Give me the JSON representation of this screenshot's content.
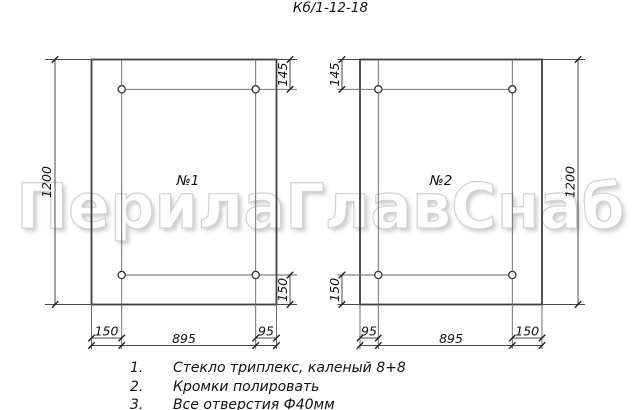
{
  "title": "Кб/1-12-18",
  "watermark": "ПерилаГлавСнаб",
  "colors": {
    "line": "#3f3f3f",
    "watermark": "#e8e8e8"
  },
  "panels": [
    {
      "label": "№1",
      "height_dim": "1200",
      "top_hole_offset_dim": "145",
      "bottom_hole_offset_dim": "150",
      "bottom_dims": [
        "150",
        "895",
        "95"
      ]
    },
    {
      "label": "№2",
      "height_dim": "1200",
      "top_hole_offset_dim": "145",
      "bottom_hole_offset_dim": "150",
      "bottom_dims": [
        "95",
        "895",
        "150"
      ]
    }
  ],
  "notes": [
    {
      "num": "1.",
      "text": "Стекло триплекс, каленый 8+8"
    },
    {
      "num": "2.",
      "text": "Кромки полировать"
    },
    {
      "num": "3.",
      "text": "Все отверстия Ф40мм"
    }
  ]
}
